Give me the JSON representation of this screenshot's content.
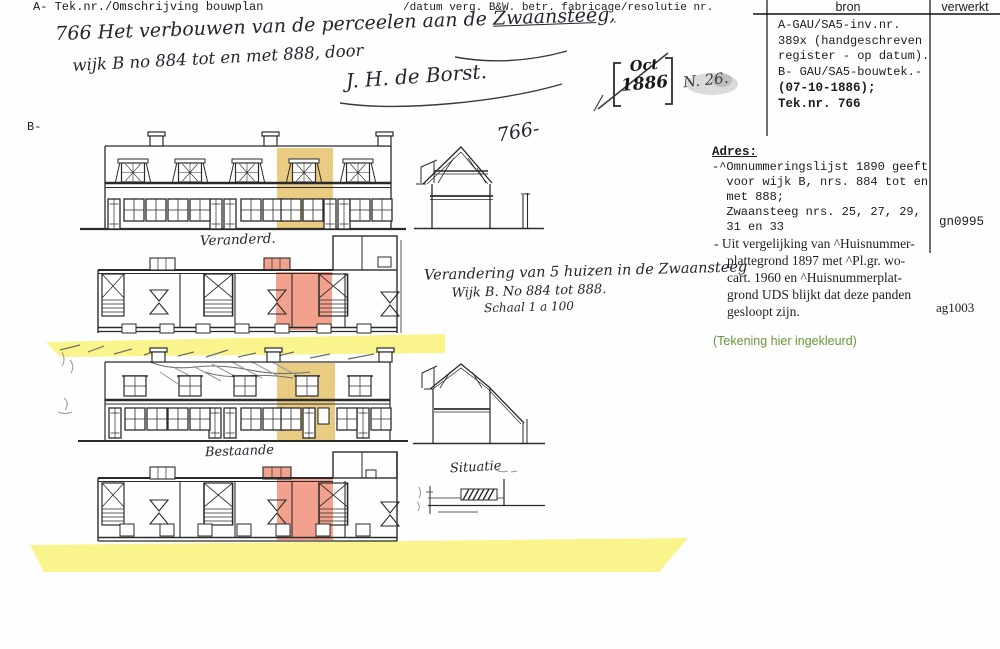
{
  "header": {
    "left": "A- Tek.nr./Omschrijving bouwplan",
    "mid": "/datum verg. B&W. betr. fabricage/resolutie nr.",
    "col_bron": "bron",
    "col_verwerkt": "verwerkt"
  },
  "bron_box": {
    "lines": [
      "A-GAU/SA5-inv.nr.",
      "389x (handgeschreven",
      "register - op datum).",
      "B- GAU/SA5-bouwtek.-",
      "(07-10-1886);",
      "Tek.nr. 766"
    ]
  },
  "adres": {
    "title": "Adres:",
    "mono_lines": [
      "-^Omnummeringslijst 1890 geeft",
      "  voor wijk B, nrs. 884 tot en",
      "  met 888;",
      "  Zwaansteeg nrs. 25, 27, 29,",
      "  31 en 33"
    ],
    "serif_lines": [
      "- Uit vergelijking van ^Huisnummer-",
      "plattegrond 1897 met ^Pl.gr. wo-",
      "cart. 1960 en ^Huisnummerplat-",
      "grond UDS blijkt dat deze panden",
      "gesloopt zijn."
    ],
    "code_gn": "gn0995",
    "code_ag": "ag1003",
    "green_note": "(Tekening hier ingekleurd)"
  },
  "handwriting": {
    "line1_pre": "766 Het verbouwen van de perceelen aan de ",
    "line1_street": "Zwaansteeg,",
    "line2": "wijk B no 884 tot en met 888, door",
    "signature": "J. H. de Borst.",
    "stamp_month": "Oct",
    "stamp_year": "1886",
    "stamp_note": "N. 26.",
    "sheet_no": "766-",
    "label_changed": "Veranderd.",
    "label_existing": "Bestaande",
    "title1": "Verandering van 5 huizen in de Zwaansteeg",
    "title2": "Wijk B. No 884 tot 888.",
    "title3": "Schaal 1 a 100",
    "label_situation": "Situatie",
    "corner": "B-"
  },
  "colors": {
    "yellow": "#f9f48b",
    "ochre": "#e9cb82",
    "salmon": "#f2a28c",
    "green": "#689636",
    "ink": "#2b2b2b",
    "pencil": "#979797",
    "rule": "#111111"
  }
}
